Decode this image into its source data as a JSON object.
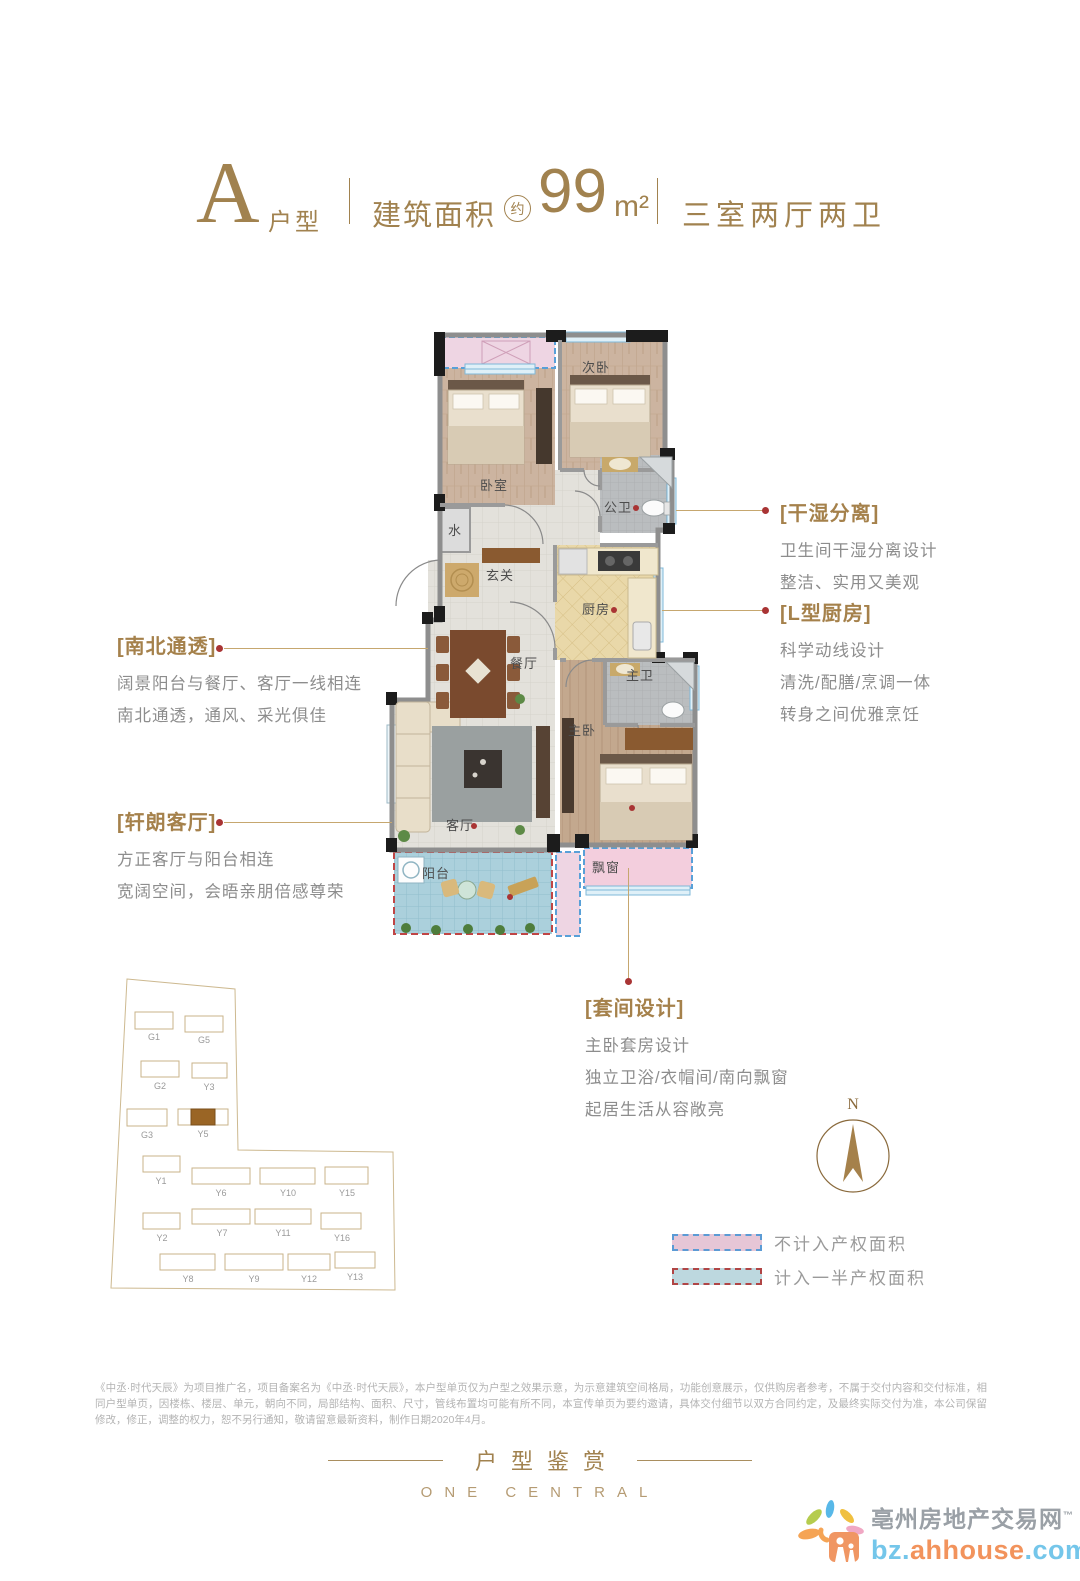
{
  "header": {
    "type_letter": "A",
    "type_label": "户型",
    "area_label": "建筑面积",
    "area_approx": "约",
    "area_value": "99",
    "area_unit": "m²",
    "rooms_label": "三室两厅两卫"
  },
  "floorplan": {
    "rooms": {
      "bedroom2": "次卧",
      "bedroom": "卧室",
      "public_bath": "公卫",
      "water": "水",
      "foyer": "玄关",
      "kitchen": "厨房",
      "dining": "餐厅",
      "living": "客厅",
      "master_bedroom": "主卧",
      "master_bath": "主卫",
      "balcony": "阳台",
      "bay_window": "飘窗"
    }
  },
  "annotations": {
    "north_south": {
      "title": "[南北通透]",
      "lines": [
        "阔景阳台与餐厅、客厅一线相连",
        "南北通透，通风、采光俱佳"
      ]
    },
    "living": {
      "title": "[轩朗客厅]",
      "lines": [
        "方正客厅与阳台相连",
        "宽阔空间，会晤亲朋倍感尊荣"
      ]
    },
    "dry_wet": {
      "title": "[干湿分离]",
      "lines": [
        "卫生间干湿分离设计",
        "整洁、实用又美观"
      ]
    },
    "kitchen": {
      "title": "[L型厨房]",
      "lines": [
        "科学动线设计",
        "清洗/配膳/烹调一体",
        "转身之间优雅烹饪"
      ]
    },
    "suite": {
      "title": "[套间设计]",
      "lines": [
        "主卧套房设计",
        "独立卫浴/衣帽间/南向飘窗",
        "起居生活从容敞亮"
      ]
    }
  },
  "siteplan": {
    "buildings": [
      {
        "id": "G1"
      },
      {
        "id": "G5"
      },
      {
        "id": "G2"
      },
      {
        "id": "Y3"
      },
      {
        "id": "G3"
      },
      {
        "id": "Y5"
      },
      {
        "id": "Y1"
      },
      {
        "id": "Y6"
      },
      {
        "id": "Y10"
      },
      {
        "id": "Y15"
      },
      {
        "id": "Y2"
      },
      {
        "id": "Y7"
      },
      {
        "id": "Y11"
      },
      {
        "id": "Y16"
      },
      {
        "id": "Y8"
      },
      {
        "id": "Y9"
      },
      {
        "id": "Y12"
      },
      {
        "id": "Y13"
      }
    ],
    "highlighted": "Y5"
  },
  "compass": {
    "north_label": "N"
  },
  "legend": {
    "items": [
      {
        "label": "不计入产权面积",
        "fill": "#e6c6d6",
        "border": "#5b9bd5"
      },
      {
        "label": "计入一半产权面积",
        "fill": "#bdd8df",
        "border": "#b04545"
      }
    ]
  },
  "disclaimer": "《中丞·时代天辰》为项目推广名，项目备案名为《中丞·时代天辰》，本户型单页仅为户型之效果示意，为示意建筑空间格局，功能创意展示，仅供购房者参考，不属于交付内容和交付标准，相同户型单页，因楼栋、楼层、单元，朝向不同，局部结构、面积、尺寸，管线布置均可能有所不同，本宣传单页为要约邀请，具体交付细节以双方合同约定，及最终实际交付为准，本公司保留修改，修正，调整的权力，恕不另行通知，敬请留意最新资料，制作日期2020年4月。",
  "footer": {
    "title": "户型鉴赏",
    "subtitle": "ONE CENTRAL"
  },
  "logo": {
    "site_name": "亳州房地产交易网",
    "trademark": "™",
    "url_prefix": "bz.",
    "url_mid": "ahhouse",
    "url_suffix": ".com"
  }
}
